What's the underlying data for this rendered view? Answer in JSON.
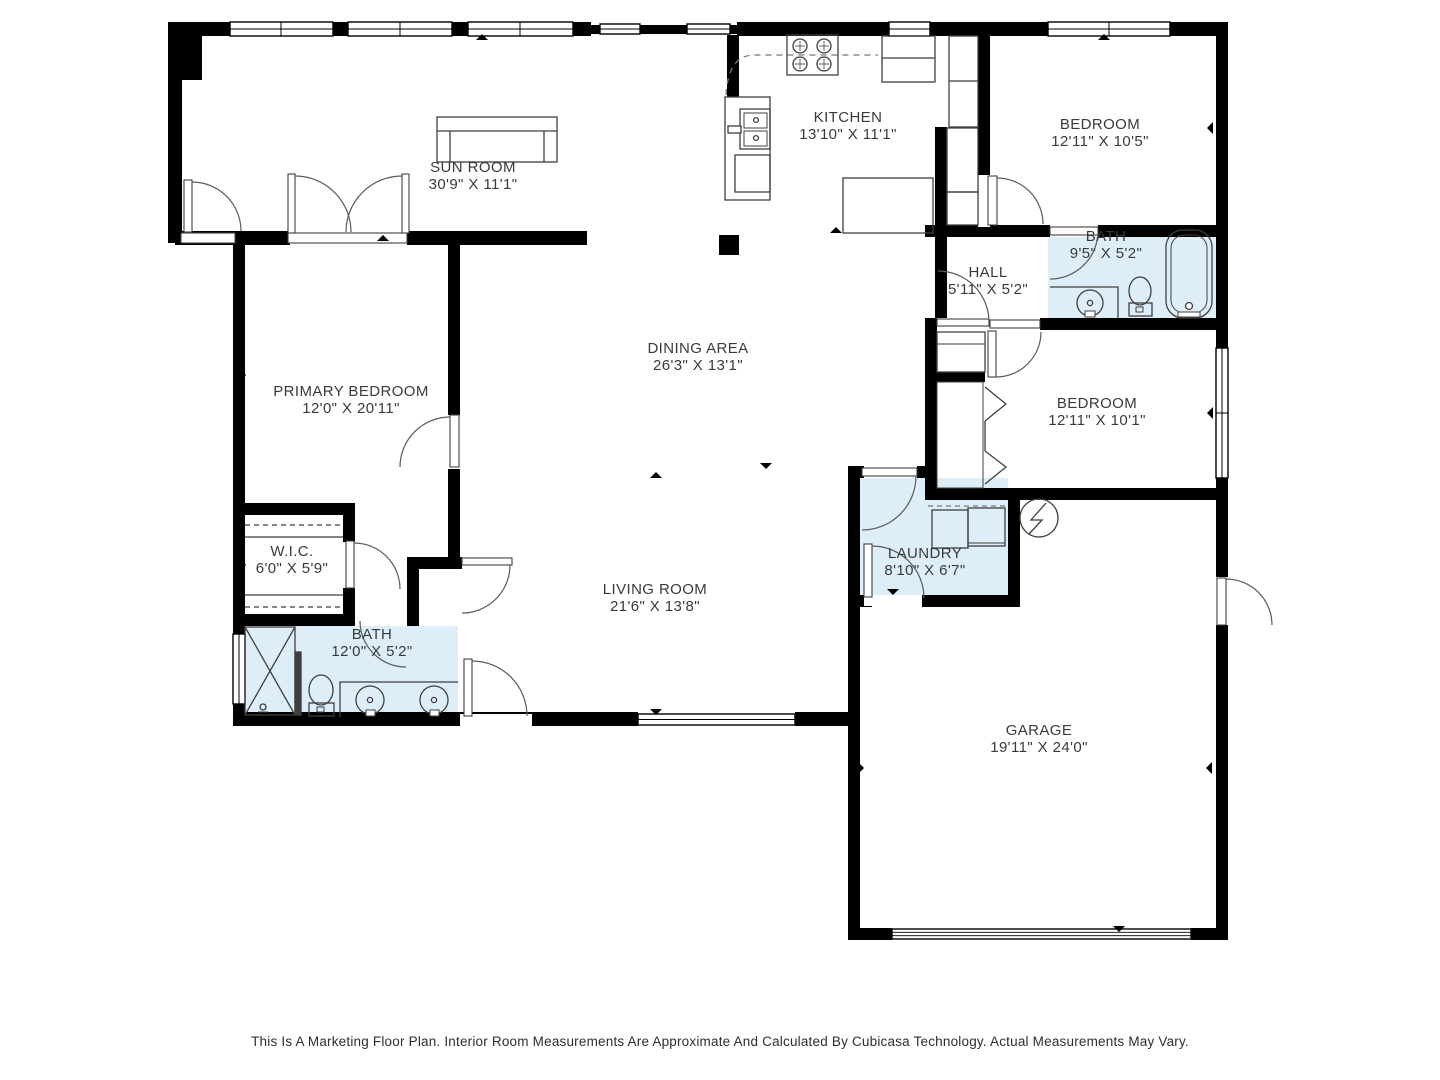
{
  "colors": {
    "wall": "#000000",
    "wet_room_fill": "#ddeef8",
    "fixture_line": "#3f3f3f",
    "door_arc": "#5a5a5a",
    "label_text": "#3a3a3a"
  },
  "rooms": [
    {
      "id": "sun-room",
      "name": "SUN ROOM",
      "dims": "30'9\" X 11'1\""
    },
    {
      "id": "kitchen",
      "name": "KITCHEN",
      "dims": "13'10\" X 11'1\""
    },
    {
      "id": "bedroom-top",
      "name": "BEDROOM",
      "dims": "12'11\" X 10'5\""
    },
    {
      "id": "bath-top",
      "name": "BATH",
      "dims": "9'5\" X 5'2\""
    },
    {
      "id": "hall",
      "name": "HALL",
      "dims": "5'11\" X 5'2\""
    },
    {
      "id": "dining-area",
      "name": "DINING AREA",
      "dims": "26'3\" X 13'1\""
    },
    {
      "id": "primary-bedroom",
      "name": "PRIMARY BEDROOM",
      "dims": "12'0\" X 20'11\""
    },
    {
      "id": "bedroom-right",
      "name": "BEDROOM",
      "dims": "12'11\" X 10'1\""
    },
    {
      "id": "wic",
      "name": "W.I.C.",
      "dims": "6'0\" X 5'9\""
    },
    {
      "id": "laundry",
      "name": "LAUNDRY",
      "dims": "8'10\" X 6'7\""
    },
    {
      "id": "bath-left",
      "name": "BATH",
      "dims": "12'0\" X 5'2\""
    },
    {
      "id": "living-room",
      "name": "LIVING ROOM",
      "dims": "21'6\" X 13'8\""
    },
    {
      "id": "garage",
      "name": "GARAGE",
      "dims": "19'11\" X 24'0\""
    }
  ],
  "fixtures": [
    "sofa",
    "stove",
    "refrigerator",
    "pantry-cabinets",
    "kitchen-sink",
    "dishwasher",
    "kitchen-island",
    "closet-shelves",
    "shower",
    "toilet",
    "double-vanity-sink",
    "bathtub",
    "vanity-sink",
    "washer",
    "dryer",
    "water-heater",
    "garage-door"
  ],
  "footer": {
    "disclaimer": "This Is A Marketing Floor Plan. Interior Room Measurements Are Approximate And Calculated By Cubicasa Technology. Actual Measurements May Vary."
  }
}
